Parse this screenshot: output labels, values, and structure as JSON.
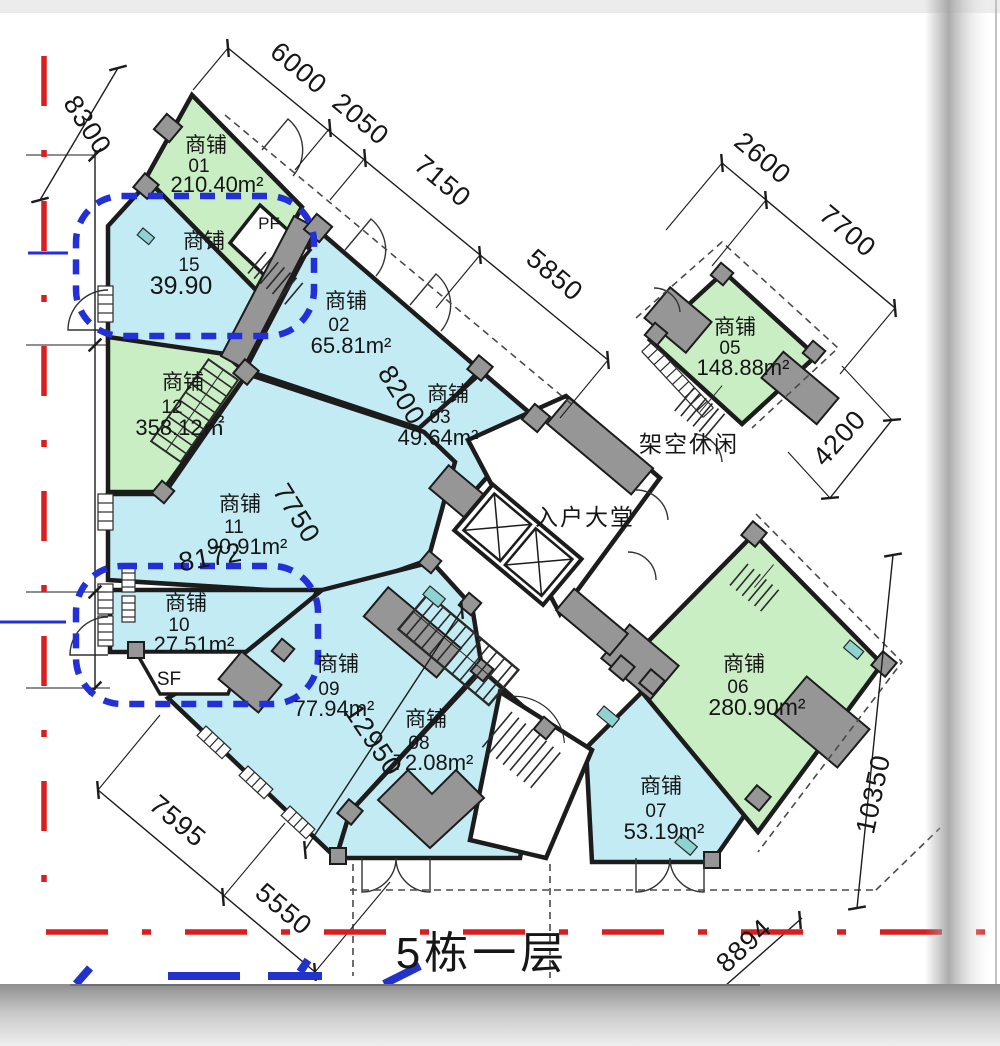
{
  "title": "5栋一层",
  "labels": {
    "shop_word": "商铺",
    "lobby": "入户大堂",
    "leisure": "架空休闲",
    "pf": "PF",
    "sf": "SF"
  },
  "shops": [
    {
      "no": "01",
      "area": "210.40m²"
    },
    {
      "no": "02",
      "area": "65.81m²"
    },
    {
      "no": "03",
      "area": "49.64m²"
    },
    {
      "no": "05",
      "area": "148.88m²"
    },
    {
      "no": "06",
      "area": "280.90m²"
    },
    {
      "no": "07",
      "area": "53.19m²"
    },
    {
      "no": "08",
      "area": "72.08m²"
    },
    {
      "no": "09",
      "area": "77.94m²"
    },
    {
      "no": "10",
      "area": "27.51m²"
    },
    {
      "no": "11",
      "area": "90.91m²"
    },
    {
      "no": "12",
      "area": "358.12㎡"
    },
    {
      "no": "15",
      "area": "39.90"
    }
  ],
  "dims": {
    "d8300": "8300",
    "d6000": "6000",
    "d2050": "2050",
    "d7150": "7150",
    "d5850": "5850",
    "d2600": "2600",
    "d7700": "7700",
    "d8200": "8200",
    "d7750": "7750",
    "d8172": "8172",
    "d12950": "12950",
    "d4200": "4200",
    "d10350": "10350",
    "d7595": "7595",
    "d5550": "5550",
    "d8894": "8894"
  },
  "colors": {
    "shop_blue": "#c3ebf4",
    "shop_green": "#c9eec4",
    "wall": "#1c1c1c",
    "column_gray": "#969696",
    "highlight_blue": "#2330d8",
    "red_line": "#d81f1f"
  }
}
